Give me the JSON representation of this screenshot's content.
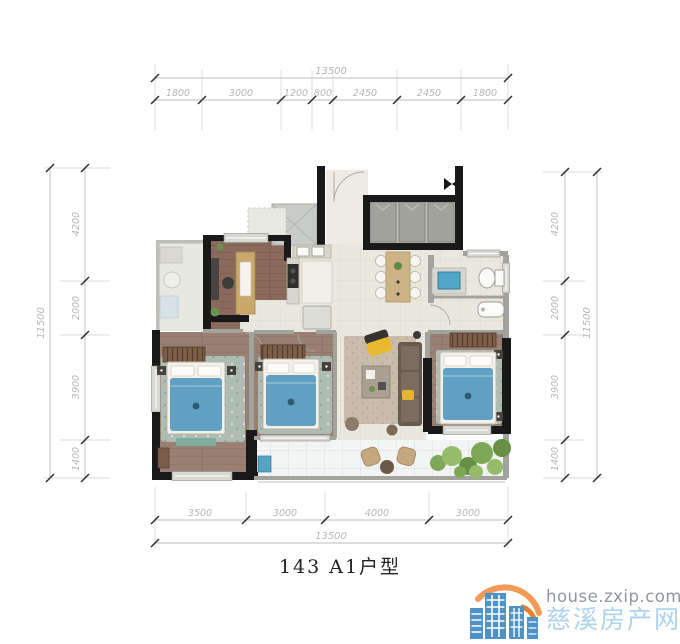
{
  "floor_plan": {
    "title": "143 A1户型",
    "dimensions": {
      "top": {
        "total": "13500",
        "segments": [
          "1800",
          "3000",
          "1200",
          "800",
          "2450",
          "2450",
          "1800"
        ]
      },
      "bottom": {
        "total": "13500",
        "segments": [
          "3500",
          "3000",
          "4000",
          "3000"
        ]
      },
      "left": {
        "total": "11500",
        "segments": [
          "4200",
          "2000",
          "3900",
          "1400"
        ]
      },
      "right": {
        "total": "11500",
        "segments": [
          "4200",
          "2000",
          "3900",
          "1400"
        ]
      }
    },
    "colors": {
      "structural_wall": "#191919",
      "partition_wall": "#a3a39d",
      "wood_floor": "#93776a",
      "tile_floor": "#eae7de",
      "bed_blue": "#5fa0c3",
      "greenery": "#7ea757",
      "dimension_text": "#b6b6b4"
    }
  },
  "watermark": {
    "site_url": "house.zxip.com",
    "site_name": "慈溪房产网",
    "logo": "buildings-and-arc-logo",
    "colors": {
      "url_text": "#8f989b",
      "name_text": "#aed3ee",
      "logo_blue": "#4e92c6",
      "logo_orange_light": "#f39a56",
      "logo_orange_dark": "#e8802e"
    }
  }
}
